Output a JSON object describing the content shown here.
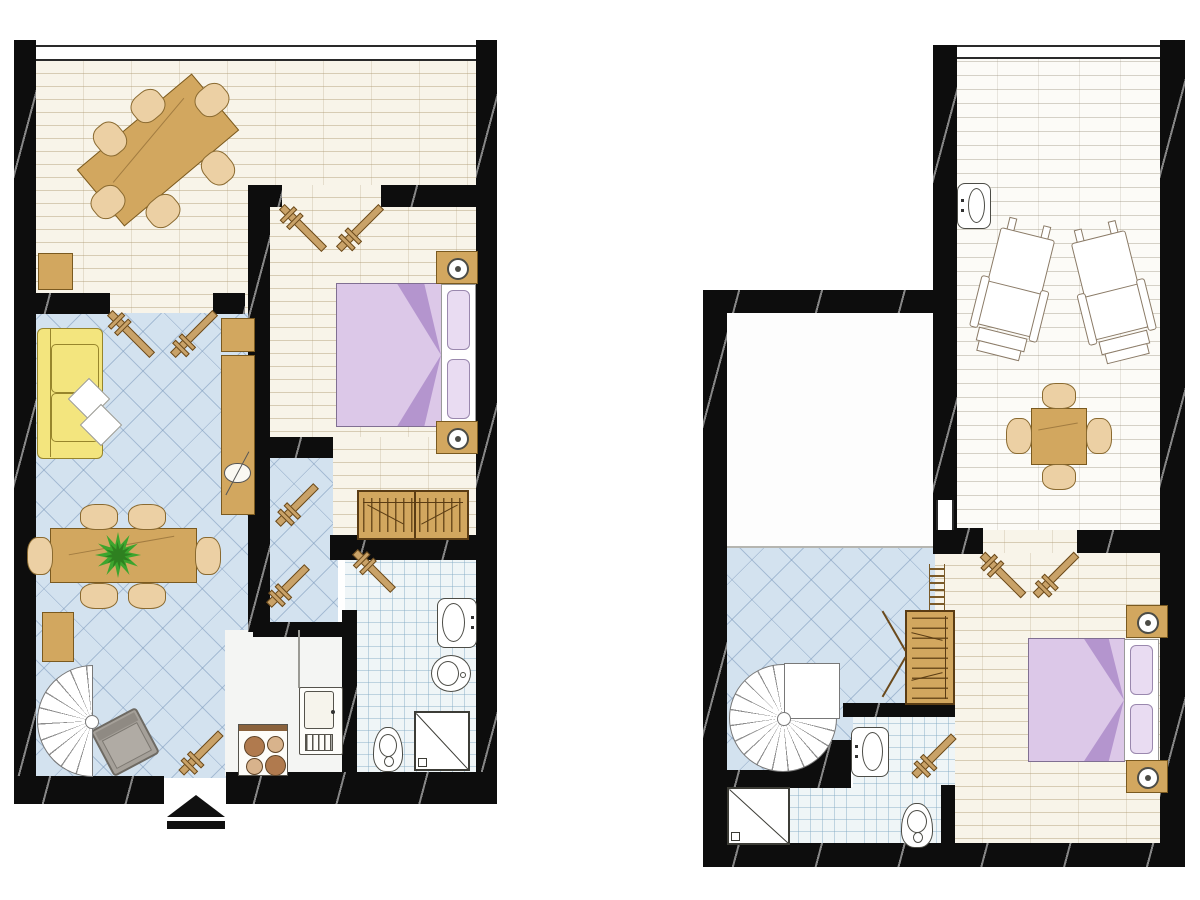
{
  "title": "two-storey-apartment-floor-plan",
  "canvas": {
    "w": 1200,
    "h": 900
  },
  "colors": {
    "wall": "#0d0d0d",
    "plank_bg": "#f8f4e9",
    "terrace_bg": "#fcfbf7",
    "tile_bg": "#d3e2ef",
    "bath_bg": "#eff5f7",
    "kitchen_bg": "#f4f5f3",
    "wood": "#d2a75f",
    "wood_dk": "#7a5a20",
    "wood_lt": "#ecd0a4",
    "sofa": "#f3e57e",
    "sofa_dk": "#97852c",
    "bed": "#dcc8e8",
    "bed_dk": "#b495ce",
    "bed_bd": "#806f92",
    "pillow": "#e9dcf2",
    "door": "#c9a268",
    "door_dk": "#6b4a1c",
    "plant": "#3da52e",
    "plant_dk": "#2e8020",
    "gray": "#a5a099",
    "white": "#ffffff"
  },
  "floors": [
    {
      "name": "ground-floor-plan",
      "rooms": [
        {
          "name": "dining-room-floor",
          "floor": "plank",
          "rect": [
            36,
            48,
            442,
            265
          ]
        },
        {
          "name": "vestibule-floor",
          "floor": "tile",
          "rect": [
            250,
            447,
            88,
            190
          ]
        },
        {
          "name": "bedroom-floor",
          "floor": "plank",
          "rect": [
            265,
            185,
            213,
            262
          ]
        },
        {
          "name": "bedroom-floor-lower",
          "floor": "plank",
          "rect": [
            333,
            437,
            145,
            110
          ]
        },
        {
          "name": "living-room-floor",
          "floor": "tile",
          "rect": [
            36,
            313,
            214,
            465
          ]
        },
        {
          "name": "kitchen-floor",
          "floor": "plain",
          "rect": [
            225,
            630,
            122,
            146
          ]
        },
        {
          "name": "bathroom-floor",
          "floor": "bath",
          "rect": [
            345,
            558,
            133,
            220
          ]
        }
      ],
      "walls": [
        [
          14,
          40,
          22,
          764
        ],
        [
          476,
          40,
          21,
          764
        ],
        [
          14,
          293,
          96,
          21
        ],
        [
          213,
          293,
          32,
          21
        ],
        [
          248,
          185,
          22,
          447
        ],
        [
          248,
          185,
          34,
          22
        ],
        [
          381,
          185,
          97,
          22
        ],
        [
          330,
          535,
          148,
          25
        ],
        [
          265,
          437,
          68,
          21
        ],
        [
          253,
          622,
          97,
          15
        ],
        [
          342,
          610,
          15,
          175
        ],
        [
          14,
          776,
          150,
          28
        ],
        [
          226,
          772,
          271,
          32
        ]
      ],
      "windows": [
        {
          "orient": "h",
          "rect": [
            36,
            45,
            440,
            16
          ]
        }
      ],
      "lines": [],
      "doors": [
        {
          "cx": 131,
          "cy": 334,
          "len": 60,
          "deg": 45
        },
        {
          "cx": 194,
          "cy": 334,
          "len": 60,
          "deg": -45
        },
        {
          "cx": 303,
          "cy": 228,
          "len": 60,
          "deg": 45
        },
        {
          "cx": 360,
          "cy": 228,
          "len": 60,
          "deg": -45
        },
        {
          "cx": 297,
          "cy": 505,
          "len": 54,
          "deg": -45
        },
        {
          "cx": 288,
          "cy": 586,
          "len": 54,
          "deg": -45
        },
        {
          "cx": 374,
          "cy": 571,
          "len": 54,
          "deg": 45
        },
        {
          "cx": 201,
          "cy": 753,
          "len": 56,
          "deg": -45
        }
      ],
      "furniture": [
        {
          "type": "tableR",
          "name": "dining-table",
          "rect": [
            83,
            113,
            150,
            74
          ],
          "deg": -40
        },
        {
          "type": "chair",
          "name": "dining-chair",
          "rect": [
            131,
            91,
            34,
            30
          ],
          "deg": -40
        },
        {
          "type": "chair",
          "name": "dining-chair",
          "rect": [
            195,
            85,
            34,
            30
          ],
          "deg": -40
        },
        {
          "type": "chair",
          "name": "dining-chair",
          "rect": [
            93,
            124,
            34,
            30
          ],
          "deg": 50
        },
        {
          "type": "chair",
          "name": "dining-chair",
          "rect": [
            91,
            187,
            34,
            30
          ],
          "deg": -40
        },
        {
          "type": "chair",
          "name": "dining-chair",
          "rect": [
            146,
            196,
            34,
            30
          ],
          "deg": -40
        },
        {
          "type": "chair",
          "name": "dining-chair",
          "rect": [
            201,
            153,
            34,
            30
          ],
          "deg": 50
        },
        {
          "type": "rect",
          "name": "stool",
          "cls": "wood",
          "rect": [
            38,
            253,
            35,
            37
          ]
        },
        {
          "type": "sofa",
          "name": "sofa",
          "rect": [
            37,
            328,
            66,
            131
          ]
        },
        {
          "type": "diamond",
          "name": "sofa-pillow",
          "rect": [
            74,
            384,
            30,
            30
          ]
        },
        {
          "type": "diamond",
          "name": "sofa-pillow",
          "rect": [
            86,
            410,
            30,
            30
          ]
        },
        {
          "type": "rect",
          "name": "cabinet",
          "cls": "wood",
          "rect": [
            221,
            318,
            34,
            34
          ]
        },
        {
          "type": "rect",
          "name": "tv-cabinet",
          "cls": "wood",
          "rect": [
            221,
            355,
            34,
            160
          ]
        },
        {
          "type": "tv",
          "name": "tv",
          "rect": [
            224,
            460,
            27,
            26
          ],
          "deg": -62
        },
        {
          "type": "tableR",
          "name": "living-table",
          "rect": [
            50,
            528,
            147,
            55
          ],
          "deg": 0
        },
        {
          "type": "chair",
          "name": "chair",
          "rect": [
            80,
            504,
            38,
            26
          ]
        },
        {
          "type": "chair",
          "name": "chair",
          "rect": [
            128,
            504,
            38,
            26
          ]
        },
        {
          "type": "chair",
          "name": "chair",
          "rect": [
            80,
            583,
            38,
            26
          ]
        },
        {
          "type": "chair",
          "name": "chair",
          "rect": [
            128,
            583,
            38,
            26
          ]
        },
        {
          "type": "chair",
          "name": "chair",
          "rect": [
            27,
            537,
            26,
            38
          ]
        },
        {
          "type": "chair",
          "name": "chair",
          "rect": [
            195,
            537,
            26,
            38
          ]
        },
        {
          "type": "plant",
          "name": "plant",
          "rect": [
            94,
            531,
            48,
            48
          ]
        },
        {
          "type": "rect",
          "name": "sideboard",
          "cls": "wood",
          "rect": [
            42,
            612,
            32,
            50
          ]
        },
        {
          "type": "grayChair",
          "name": "armchair",
          "rect": [
            99,
            716,
            52,
            52
          ],
          "deg": -28
        },
        {
          "type": "spiralHalf",
          "name": "spiral-staircase",
          "rect": [
            37,
            665,
            56,
            112
          ]
        },
        {
          "type": "line",
          "name": "counter-edge",
          "rect": [
            298,
            630,
            2,
            58
          ],
          "color": "#9a9a94"
        },
        {
          "type": "stove",
          "name": "stove",
          "rect": [
            238,
            724,
            50,
            52
          ]
        },
        {
          "type": "fridge",
          "name": "kitchen-unit",
          "rect": [
            299,
            687,
            44,
            68
          ]
        },
        {
          "type": "wardrobeH",
          "name": "wardrobe",
          "rect": [
            357,
            490,
            112,
            50
          ]
        },
        {
          "type": "bed",
          "name": "double-bed",
          "rect": [
            336,
            283,
            141,
            144
          ]
        },
        {
          "type": "nightstand",
          "name": "nightstand",
          "rect": [
            436,
            251,
            42,
            33
          ]
        },
        {
          "type": "nightstand",
          "name": "nightstand",
          "rect": [
            436,
            421,
            42,
            33
          ]
        },
        {
          "type": "sink",
          "name": "bathroom-sink",
          "rect": [
            437,
            598,
            40,
            50
          ],
          "faucet": "right"
        },
        {
          "type": "bidet",
          "name": "bidet",
          "rect": [
            431,
            655,
            40,
            37
          ]
        },
        {
          "type": "toilet",
          "name": "toilet",
          "rect": [
            373,
            727,
            30,
            45
          ]
        },
        {
          "type": "shower",
          "name": "shower",
          "rect": [
            414,
            711,
            56,
            60
          ]
        },
        {
          "type": "arrow",
          "name": "entrance-arrow",
          "rect": [
            167,
            795,
            58,
            34
          ]
        }
      ]
    },
    {
      "name": "upper-floor-plan",
      "rooms": [
        {
          "name": "terrace-floor",
          "floor": "terrace",
          "rect": [
            957,
            48,
            203,
            487
          ]
        },
        {
          "name": "open-room-floor",
          "floor": "white",
          "rect": [
            727,
            313,
            206,
            235
          ]
        },
        {
          "name": "stair-room-floor",
          "floor": "tile",
          "rect": [
            727,
            548,
            208,
            224
          ]
        },
        {
          "name": "bedroom2-floor",
          "floor": "plank",
          "rect": [
            935,
            553,
            225,
            290
          ]
        },
        {
          "name": "passage-floor",
          "floor": "plank",
          "rect": [
            957,
            530,
            120,
            23
          ]
        },
        {
          "name": "bathroom2-floor-a",
          "floor": "bath",
          "rect": [
            853,
            717,
            102,
            126
          ]
        },
        {
          "name": "bathroom2-floor-b",
          "floor": "bath",
          "rect": [
            727,
            787,
            126,
            56
          ]
        }
      ],
      "walls": [
        [
          933,
          45,
          24,
          503
        ],
        [
          1160,
          40,
          25,
          827
        ],
        [
          703,
          290,
          234,
          23
        ],
        [
          703,
          290,
          24,
          577
        ],
        [
          703,
          843,
          482,
          24
        ],
        [
          1077,
          530,
          108,
          23
        ],
        [
          933,
          528,
          50,
          26
        ],
        [
          703,
          770,
          148,
          18
        ],
        [
          795,
          740,
          56,
          48
        ],
        [
          843,
          703,
          112,
          14
        ],
        [
          941,
          785,
          14,
          60
        ]
      ],
      "windows": [
        {
          "orient": "h",
          "rect": [
            957,
            45,
            203,
            14
          ]
        },
        {
          "orient": "v",
          "rect": [
            936,
            500,
            18,
            30
          ]
        }
      ],
      "lines": [
        {
          "name": "floor-divider",
          "rect": [
            727,
            546,
            208,
            2
          ],
          "color": "#b5b5b0"
        }
      ],
      "doors": [
        {
          "cx": 1003,
          "cy": 575,
          "len": 58,
          "deg": 45
        },
        {
          "cx": 1056,
          "cy": 575,
          "len": 58,
          "deg": -45
        },
        {
          "cx": 934,
          "cy": 756,
          "len": 56,
          "deg": -45
        }
      ],
      "furniture": [
        {
          "type": "sink",
          "name": "terrace-sink",
          "rect": [
            957,
            183,
            34,
            46
          ],
          "faucet": "left"
        },
        {
          "type": "lounge",
          "name": "lounge-chair",
          "rect": [
            983,
            220,
            62,
            140
          ],
          "deg": 14
        },
        {
          "type": "lounge",
          "name": "lounge-chair",
          "rect": [
            1081,
            223,
            62,
            140
          ],
          "deg": -14
        },
        {
          "type": "tableR",
          "name": "terrace-table",
          "rect": [
            1031,
            408,
            56,
            57
          ],
          "deg": 0
        },
        {
          "type": "chair",
          "name": "chair",
          "rect": [
            1042,
            383,
            34,
            26
          ]
        },
        {
          "type": "chair",
          "name": "chair",
          "rect": [
            1042,
            464,
            34,
            26
          ]
        },
        {
          "type": "chair",
          "name": "chair",
          "rect": [
            1006,
            418,
            26,
            36
          ]
        },
        {
          "type": "chair",
          "name": "chair",
          "rect": [
            1086,
            418,
            26,
            36
          ]
        },
        {
          "type": "coil",
          "name": "radiator-coil",
          "rect": [
            929,
            564,
            16,
            48
          ]
        },
        {
          "type": "wardrobeV",
          "name": "wardrobe",
          "rect": [
            905,
            610,
            50,
            95
          ]
        },
        {
          "type": "line",
          "name": "wardrobe-door",
          "rect": [
            871,
            630,
            46,
            2
          ],
          "deg": 60,
          "color": "#6b4a1c"
        },
        {
          "type": "line",
          "name": "wardrobe-door",
          "rect": [
            871,
            676,
            46,
            2
          ],
          "deg": -60,
          "color": "#6b4a1c"
        },
        {
          "type": "spiralFull",
          "name": "spiral-staircase",
          "rect": [
            729,
            664,
            108,
            108
          ]
        },
        {
          "type": "bed",
          "name": "double-bed",
          "rect": [
            1028,
            638,
            132,
            124
          ]
        },
        {
          "type": "nightstand",
          "name": "nightstand",
          "rect": [
            1126,
            605,
            42,
            33
          ]
        },
        {
          "type": "nightstand",
          "name": "nightstand",
          "rect": [
            1126,
            760,
            42,
            33
          ]
        },
        {
          "type": "sink",
          "name": "bathroom-sink",
          "rect": [
            851,
            727,
            38,
            50
          ],
          "faucet": "left"
        },
        {
          "type": "toilet",
          "name": "toilet",
          "rect": [
            901,
            803,
            32,
            45
          ]
        },
        {
          "type": "shower",
          "name": "shower",
          "rect": [
            727,
            787,
            63,
            58
          ]
        }
      ]
    }
  ]
}
